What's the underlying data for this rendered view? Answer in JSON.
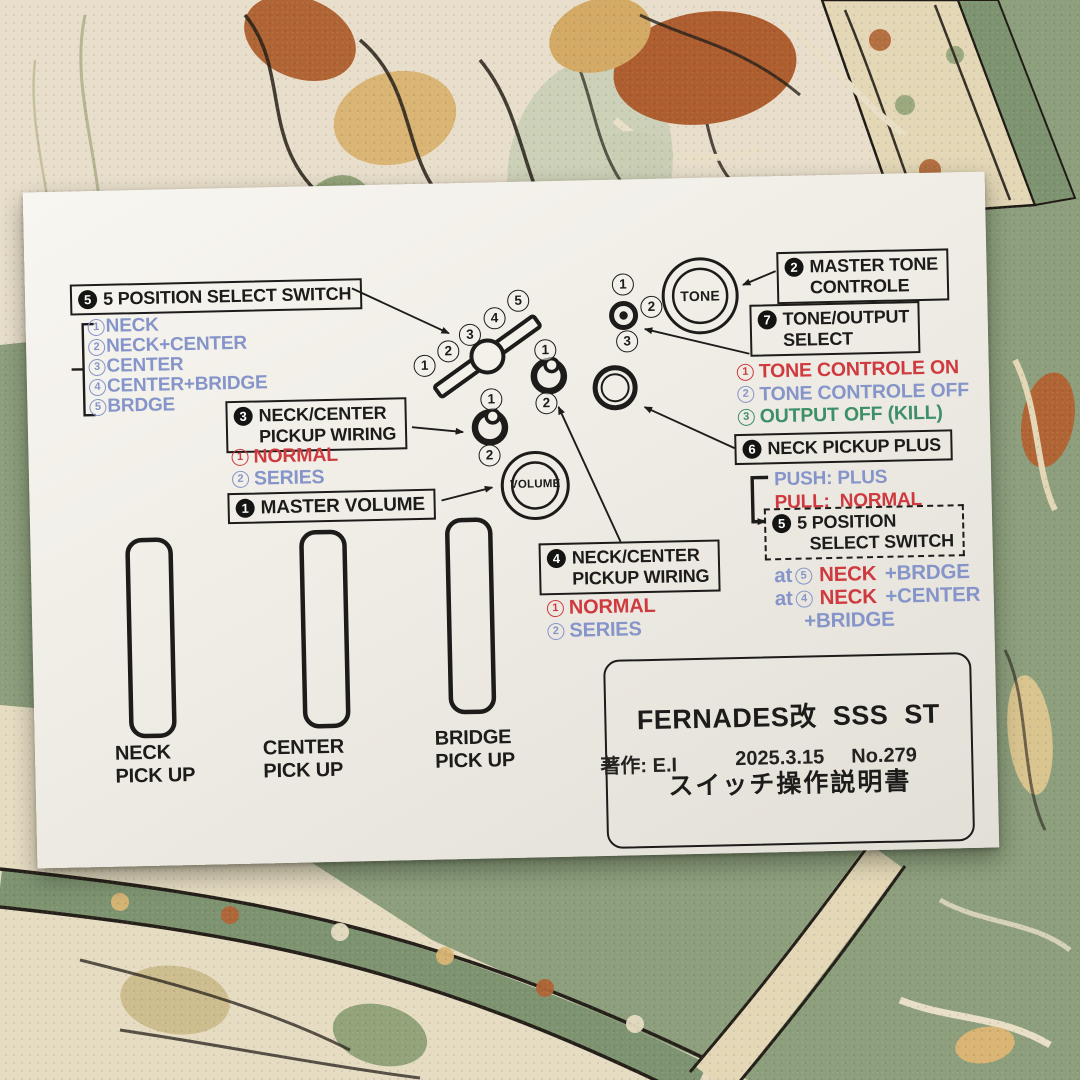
{
  "palette": {
    "red": "#cf3a3f",
    "blue": "#8595c9",
    "green": "#3e8f68",
    "ink": "#1d1c1a",
    "paper": "#f1eee7",
    "carpet_green": "#8c9e7c",
    "carpet_cream": "#e8decb",
    "carpet_rust": "#ad5d2e"
  },
  "boxes": {
    "five_position": {
      "badge": "5",
      "line1": "5 POSITION SELECT SWITCH"
    },
    "neck_center_3": {
      "badge": "3",
      "line1": "NECK/CENTER",
      "line2": "PICKUP WIRING"
    },
    "master_volume": {
      "badge": "1",
      "line1": "MASTER VOLUME"
    },
    "master_tone": {
      "badge": "2",
      "line1": "MASTER TONE",
      "line2": "CONTROLE"
    },
    "tone_output": {
      "badge": "7",
      "line1": "TONE/OUTPUT",
      "line2": "SELECT"
    },
    "neck_pickup_plus": {
      "badge": "6",
      "line1": "NECK PICKUP PLUS"
    },
    "neck_center_4": {
      "badge": "4",
      "line1": "NECK/CENTER",
      "line2": "PICKUP WIRING"
    },
    "five_position_dashed": {
      "badge": "5",
      "line1": "5 POSITION",
      "line2": "SELECT SWITCH"
    }
  },
  "position_list": [
    {
      "num": "1",
      "text": "NECK"
    },
    {
      "num": "2",
      "text": "NECK+CENTER"
    },
    {
      "num": "3",
      "text": "CENTER"
    },
    {
      "num": "4",
      "text": "CENTER+BRIDGE"
    },
    {
      "num": "5",
      "text": "BRDGE"
    }
  ],
  "wiring_list_3": [
    {
      "num": "1",
      "text": "NORMAL",
      "color": "red"
    },
    {
      "num": "2",
      "text": "SERIES",
      "color": "blue"
    }
  ],
  "wiring_list_4": [
    {
      "num": "1",
      "text": "NORMAL",
      "color": "red"
    },
    {
      "num": "2",
      "text": "SERIES",
      "color": "blue"
    }
  ],
  "tone_output_list": [
    {
      "num": "1",
      "text": "TONE CONTROLE ON",
      "color": "red"
    },
    {
      "num": "2",
      "text": "TONE CONTROLE OFF",
      "color": "blue"
    },
    {
      "num": "3",
      "text": "OUTPUT OFF (KILL)",
      "color": "green"
    }
  ],
  "push_pull": [
    {
      "text": "PUSH: PLUS",
      "color": "blue"
    },
    {
      "text": "PULL:  NORMAL",
      "color": "red"
    }
  ],
  "combo_notes": [
    {
      "prefix": "at",
      "num": "5",
      "main": "NECK",
      "rest": " +BRDGE"
    },
    {
      "prefix": "at",
      "num": "4",
      "main": "NECK",
      "rest": " +CENTER"
    },
    {
      "cont": "+BRIDGE"
    }
  ],
  "diagram": {
    "switch_nums": [
      "1",
      "2",
      "3",
      "4",
      "5"
    ],
    "pot3_nums": [
      "1",
      "2"
    ],
    "pot4_nums": [
      "1",
      "2"
    ],
    "toggle_nums": [
      "1",
      "2",
      "3"
    ],
    "knob_tone": "TONE",
    "knob_volume": "VOLUME"
  },
  "pickups": [
    {
      "line1": "NECK",
      "line2": "PICK UP"
    },
    {
      "line1": "CENTER",
      "line2": "PICK UP"
    },
    {
      "line1": "BRIDGE",
      "line2": "PICK UP"
    }
  ],
  "title_box": {
    "line1": "FERNADES改  SSS  ST",
    "line2": "スイッチ操作説明書"
  },
  "credit": {
    "author": "著作: E.I",
    "date": "2025.3.15",
    "number": "No.279"
  }
}
